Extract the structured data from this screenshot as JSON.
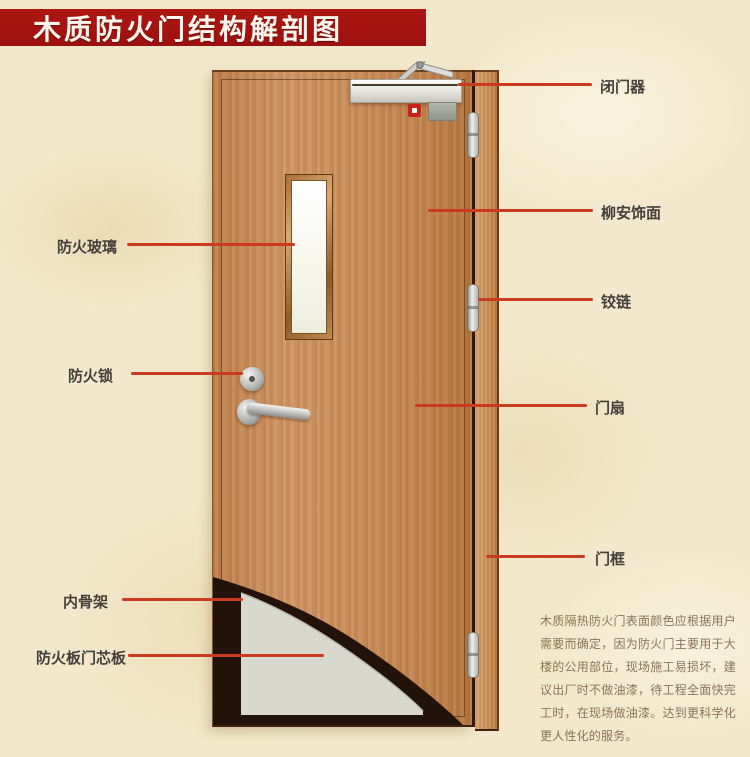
{
  "title": "木质防火门结构解剖图",
  "labels": {
    "left": [
      {
        "text": "防火玻璃"
      },
      {
        "text": "防火锁"
      },
      {
        "text": "内骨架"
      },
      {
        "text": "防火板门芯板"
      }
    ],
    "right": [
      {
        "text": "闭门器"
      },
      {
        "text": "柳安饰面"
      },
      {
        "text": "铰链"
      },
      {
        "text": "门扇"
      },
      {
        "text": "门框"
      }
    ]
  },
  "description": "木质隔热防火门表面颜色应根据用户需要而确定，因为防火门主要用于大楼的公用部位，现场施工易损坏，建议出厂时不做油漆，待工程全面快完工时，在现场做油漆。达到更科学化更人性化的服务。",
  "colors": {
    "banner": "#a31410",
    "leader_line": "#c93a1e",
    "label_text": "#45403a",
    "description_text": "#8a7458",
    "door_wood": "#c88c5b",
    "door_frame_wood": "#cf9a64",
    "core_panel_gray": "#d8d8cf",
    "inner_frame_dark": "#23120a",
    "background": "#f3e8cc"
  }
}
